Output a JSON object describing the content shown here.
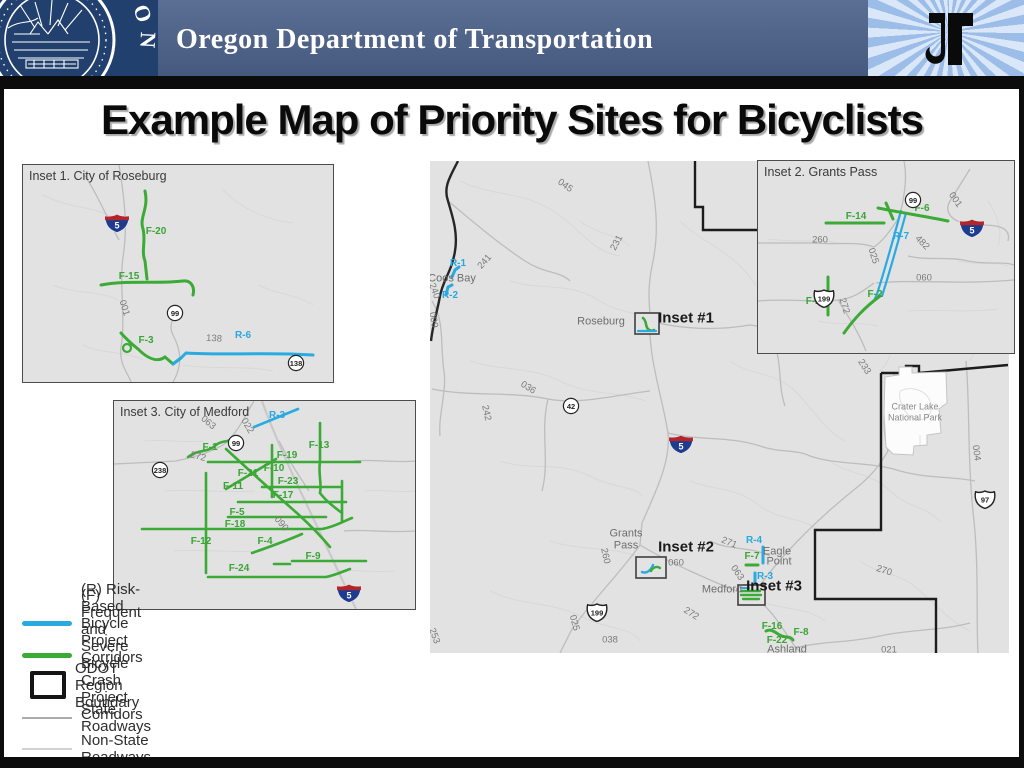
{
  "header": {
    "agency": "Oregon Department of Transportation",
    "seal_arc_text": "GON"
  },
  "title": "Example Map of Priority Sites for Bicyclists",
  "colors": {
    "banner_blue": "#4b6189",
    "seal_blue": "#21406e",
    "risk_corridor_cyan": "#29abe2",
    "crash_corridor_green": "#3caa36",
    "map_background": "#e2e2e2"
  },
  "legend": {
    "items": [
      {
        "label": "(R) Risk-Based Bicycle Project Corridors",
        "swatch": "risk-line"
      },
      {
        "label": "(F) Frequent and Severe Bicycle Crash Project Corridors",
        "swatch": "crash-line"
      },
      {
        "label": "ODOT Region Boundary",
        "swatch": "boundary-box"
      },
      {
        "label": "State Roadways",
        "swatch": "state-line"
      },
      {
        "label": "Non-State Roadways",
        "swatch": "nonstate-line"
      }
    ]
  },
  "main_map": {
    "labels": [
      {
        "t": "045",
        "x": 135,
        "y": 25,
        "r": 35,
        "c": "road"
      },
      {
        "t": "231",
        "x": 187,
        "y": 82,
        "r": -62,
        "c": "road"
      },
      {
        "t": "241",
        "x": 55,
        "y": 101,
        "r": -48,
        "c": "road"
      },
      {
        "t": "R-1",
        "x": 28,
        "y": 103,
        "c": "cyan"
      },
      {
        "t": "Coos Bay",
        "x": 22,
        "y": 118,
        "c": "city"
      },
      {
        "t": "R-2",
        "x": 20,
        "y": 135,
        "c": "cyan"
      },
      {
        "t": "240",
        "x": 4,
        "y": 130,
        "r": 70,
        "c": "road"
      },
      {
        "t": "009",
        "x": 3,
        "y": 159,
        "r": 80,
        "c": "road"
      },
      {
        "t": "036",
        "x": 98,
        "y": 227,
        "r": 32,
        "c": "road"
      },
      {
        "t": "242",
        "x": 56,
        "y": 252,
        "r": 78,
        "c": "road"
      },
      {
        "t": "Roseburg",
        "x": 171,
        "y": 161,
        "c": "city"
      },
      {
        "t": "Inset #1",
        "x": 256,
        "y": 157,
        "c": "ref"
      },
      {
        "t": "Grants",
        "x": 196,
        "y": 373,
        "c": "city"
      },
      {
        "t": "Pass",
        "x": 196,
        "y": 385,
        "c": "city"
      },
      {
        "t": "260",
        "x": 175,
        "y": 395,
        "r": 78,
        "c": "road"
      },
      {
        "t": "Inset #2",
        "x": 256,
        "y": 386,
        "c": "ref"
      },
      {
        "t": "060",
        "x": 246,
        "y": 402,
        "c": "road"
      },
      {
        "t": "271",
        "x": 299,
        "y": 382,
        "r": 22,
        "c": "road"
      },
      {
        "t": "R-4",
        "x": 324,
        "y": 380,
        "c": "cyan"
      },
      {
        "t": "Eagle",
        "x": 347,
        "y": 391,
        "c": "city"
      },
      {
        "t": "Point",
        "x": 349,
        "y": 401,
        "c": "city"
      },
      {
        "t": "F-7",
        "x": 322,
        "y": 396,
        "c": "green"
      },
      {
        "t": "063",
        "x": 307,
        "y": 412,
        "r": 55,
        "c": "road"
      },
      {
        "t": "R-3",
        "x": 335,
        "y": 416,
        "c": "cyan"
      },
      {
        "t": "Medford",
        "x": 292,
        "y": 429,
        "c": "city"
      },
      {
        "t": "Inset #3",
        "x": 344,
        "y": 425,
        "c": "ref"
      },
      {
        "t": "272",
        "x": 261,
        "y": 453,
        "r": 32,
        "c": "road"
      },
      {
        "t": "025",
        "x": 144,
        "y": 462,
        "r": 75,
        "c": "road"
      },
      {
        "t": "038",
        "x": 180,
        "y": 479,
        "c": "road"
      },
      {
        "t": "F-16",
        "x": 342,
        "y": 466,
        "c": "green"
      },
      {
        "t": "F-8",
        "x": 371,
        "y": 472,
        "c": "green"
      },
      {
        "t": "F-22",
        "x": 347,
        "y": 480,
        "c": "green"
      },
      {
        "t": "Ashland",
        "x": 357,
        "y": 489,
        "c": "city"
      },
      {
        "t": "270",
        "x": 454,
        "y": 410,
        "r": 18,
        "c": "road"
      },
      {
        "t": "021",
        "x": 459,
        "y": 489,
        "c": "road"
      },
      {
        "t": "004",
        "x": 546,
        "y": 292,
        "r": 82,
        "c": "road"
      },
      {
        "t": "233",
        "x": 434,
        "y": 206,
        "r": 58,
        "c": "road"
      },
      {
        "t": "253",
        "x": 4,
        "y": 475,
        "r": 70,
        "c": "road"
      },
      {
        "t": "Crater Lake",
        "x": 485,
        "y": 246,
        "c": "park"
      },
      {
        "t": "National Park",
        "x": 485,
        "y": 257,
        "c": "park"
      }
    ],
    "shields": [
      {
        "k": "c",
        "t": "42",
        "x": 132,
        "y": 236
      },
      {
        "k": "i",
        "t": "5",
        "x": 238,
        "y": 274
      },
      {
        "k": "us",
        "t": "199",
        "x": 156,
        "y": 442
      },
      {
        "k": "us",
        "t": "97",
        "x": 544,
        "y": 329
      }
    ]
  },
  "inset1": {
    "title": "Inset 1. City of Roseburg",
    "labels": [
      {
        "t": "F-20",
        "x": 133,
        "y": 67,
        "c": "green"
      },
      {
        "t": "F-15",
        "x": 106,
        "y": 112,
        "c": "green"
      },
      {
        "t": "001",
        "x": 101,
        "y": 143,
        "r": 72,
        "c": "road"
      },
      {
        "t": "F-3",
        "x": 123,
        "y": 176,
        "c": "green"
      },
      {
        "t": "138",
        "x": 191,
        "y": 174,
        "r": 4,
        "c": "road"
      },
      {
        "t": "R-6",
        "x": 220,
        "y": 171,
        "c": "cyan"
      }
    ],
    "shields": [
      {
        "k": "i",
        "t": "5",
        "x": 81,
        "y": 49
      },
      {
        "k": "c",
        "t": "99",
        "x": 143,
        "y": 139
      },
      {
        "k": "c",
        "t": "138",
        "x": 264,
        "y": 189
      }
    ]
  },
  "inset2": {
    "title": "Inset 2. Grants Pass",
    "labels": [
      {
        "t": "001",
        "x": 197,
        "y": 39,
        "r": 55,
        "c": "road"
      },
      {
        "t": "F-6",
        "x": 164,
        "y": 48,
        "c": "green"
      },
      {
        "t": "F-14",
        "x": 98,
        "y": 56,
        "c": "green"
      },
      {
        "t": "R-7",
        "x": 143,
        "y": 76,
        "c": "cyan"
      },
      {
        "t": "260",
        "x": 62,
        "y": 79,
        "c": "road"
      },
      {
        "t": "025",
        "x": 115,
        "y": 95,
        "r": 72,
        "c": "road"
      },
      {
        "t": "482",
        "x": 164,
        "y": 82,
        "r": 45,
        "c": "road"
      },
      {
        "t": "060",
        "x": 166,
        "y": 117,
        "c": "road"
      },
      {
        "t": "F-2",
        "x": 117,
        "y": 134,
        "c": "green"
      },
      {
        "t": "272",
        "x": 86,
        "y": 145,
        "r": 72,
        "c": "road"
      },
      {
        "t": "F-25",
        "x": 58,
        "y": 141,
        "c": "green"
      }
    ],
    "shields": [
      {
        "k": "c",
        "t": "99",
        "x": 146,
        "y": 30
      },
      {
        "k": "i",
        "t": "5",
        "x": 201,
        "y": 58
      },
      {
        "k": "us",
        "t": "199",
        "x": 55,
        "y": 128
      }
    ]
  },
  "inset3": {
    "title": "Inset 3. City of Medford",
    "labels": [
      {
        "t": "R-3",
        "x": 163,
        "y": 15,
        "c": "cyan"
      },
      {
        "t": "063",
        "x": 94,
        "y": 22,
        "r": 40,
        "c": "road"
      },
      {
        "t": "022",
        "x": 133,
        "y": 25,
        "r": 60,
        "c": "road"
      },
      {
        "t": "272",
        "x": 84,
        "y": 56,
        "r": 14,
        "c": "road"
      },
      {
        "t": "F-1",
        "x": 96,
        "y": 47,
        "c": "green"
      },
      {
        "t": "F-13",
        "x": 205,
        "y": 45,
        "c": "green"
      },
      {
        "t": "F-19",
        "x": 173,
        "y": 55,
        "c": "green"
      },
      {
        "t": "F-10",
        "x": 160,
        "y": 68,
        "c": "green"
      },
      {
        "t": "F-21",
        "x": 134,
        "y": 73,
        "c": "green"
      },
      {
        "t": "F-23",
        "x": 174,
        "y": 81,
        "c": "green"
      },
      {
        "t": "F-11",
        "x": 119,
        "y": 86,
        "c": "green"
      },
      {
        "t": "F-17",
        "x": 169,
        "y": 95,
        "c": "green"
      },
      {
        "t": "F-5",
        "x": 123,
        "y": 112,
        "c": "green"
      },
      {
        "t": "F-18",
        "x": 121,
        "y": 124,
        "c": "green"
      },
      {
        "t": "090",
        "x": 167,
        "y": 123,
        "r": 50,
        "c": "road"
      },
      {
        "t": "F-12",
        "x": 87,
        "y": 141,
        "c": "green"
      },
      {
        "t": "F-4",
        "x": 151,
        "y": 141,
        "c": "green"
      },
      {
        "t": "F-9",
        "x": 199,
        "y": 156,
        "c": "green"
      },
      {
        "t": "F-24",
        "x": 125,
        "y": 168,
        "c": "green"
      }
    ],
    "shields": [
      {
        "k": "c",
        "t": "99",
        "x": 113,
        "y": 33
      },
      {
        "k": "c",
        "t": "238",
        "x": 37,
        "y": 60
      },
      {
        "k": "i",
        "t": "5",
        "x": 222,
        "y": 183
      }
    ]
  }
}
